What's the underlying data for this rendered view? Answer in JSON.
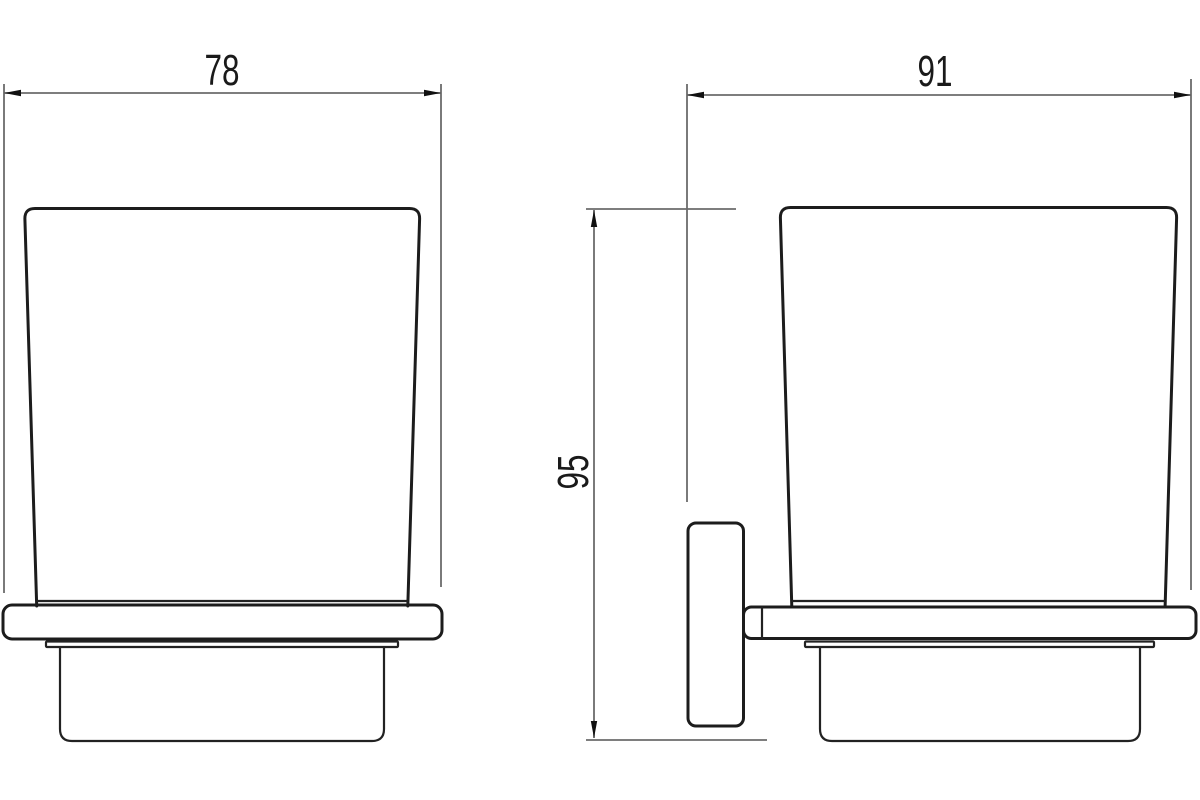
{
  "drawing": {
    "dimensions": {
      "front_width": {
        "value": "78",
        "orientation": "horizontal",
        "view": "front"
      },
      "side_depth": {
        "value": "91",
        "orientation": "horizontal",
        "view": "side"
      },
      "side_height": {
        "value": "95",
        "orientation": "vertical",
        "view": "side"
      }
    },
    "colors": {
      "outline": "#1c1c1c",
      "dimension_line": "#6b6b6b",
      "label_text": "#1a1a1a",
      "background": "#ffffff"
    }
  }
}
